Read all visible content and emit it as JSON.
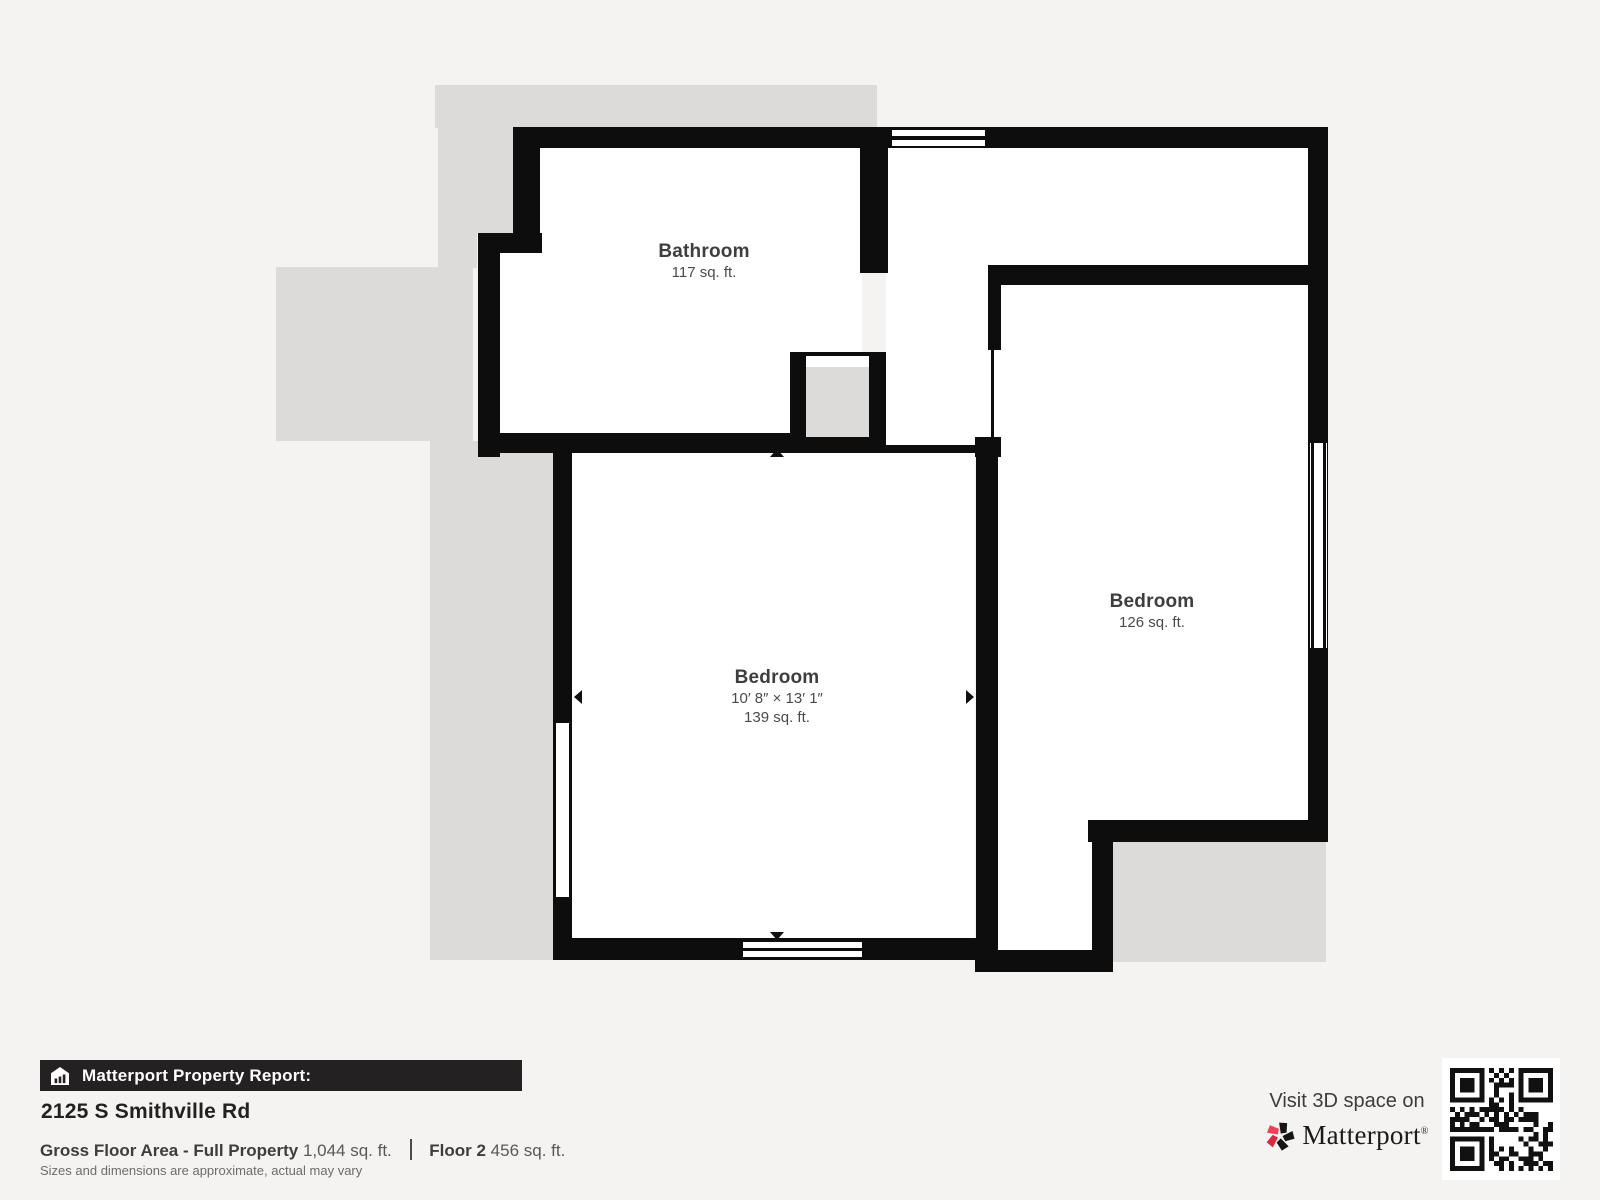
{
  "floorplan": {
    "rooms": [
      {
        "id": "bathroom",
        "name": "Bathroom",
        "area": "117 sq. ft."
      },
      {
        "id": "bedroom-main",
        "name": "Bedroom",
        "dimensions": "10′ 8″ × 13′ 1″",
        "area": "139 sq. ft."
      },
      {
        "id": "bedroom-right",
        "name": "Bedroom",
        "area": "126 sq. ft."
      }
    ]
  },
  "footer": {
    "report_label": "Matterport Property Report:",
    "address": "2125 S Smithville Rd",
    "gross_label": "Gross Floor Area - Full Property",
    "gross_value": "1,044 sq. ft.",
    "floor_label": "Floor 2",
    "floor_value": "456 sq. ft.",
    "disclaimer": "Sizes and dimensions are approximate, actual may vary"
  },
  "cta": {
    "visit_text": "Visit 3D space on",
    "brand": "Matterport",
    "trademark": "®",
    "qr_icon": "qr-code"
  },
  "icons": {
    "banner_icon": "house-report-icon",
    "brand_icon": "matterport-pinwheel-icon"
  },
  "colors": {
    "background": "#f4f3f1",
    "underlay": "#dcdbd9",
    "wall": "#0d0d0d",
    "floor": "#ffffff",
    "banner": "#242122",
    "brand_red": "#f0415a",
    "brand_red_dark": "#d92a45"
  }
}
